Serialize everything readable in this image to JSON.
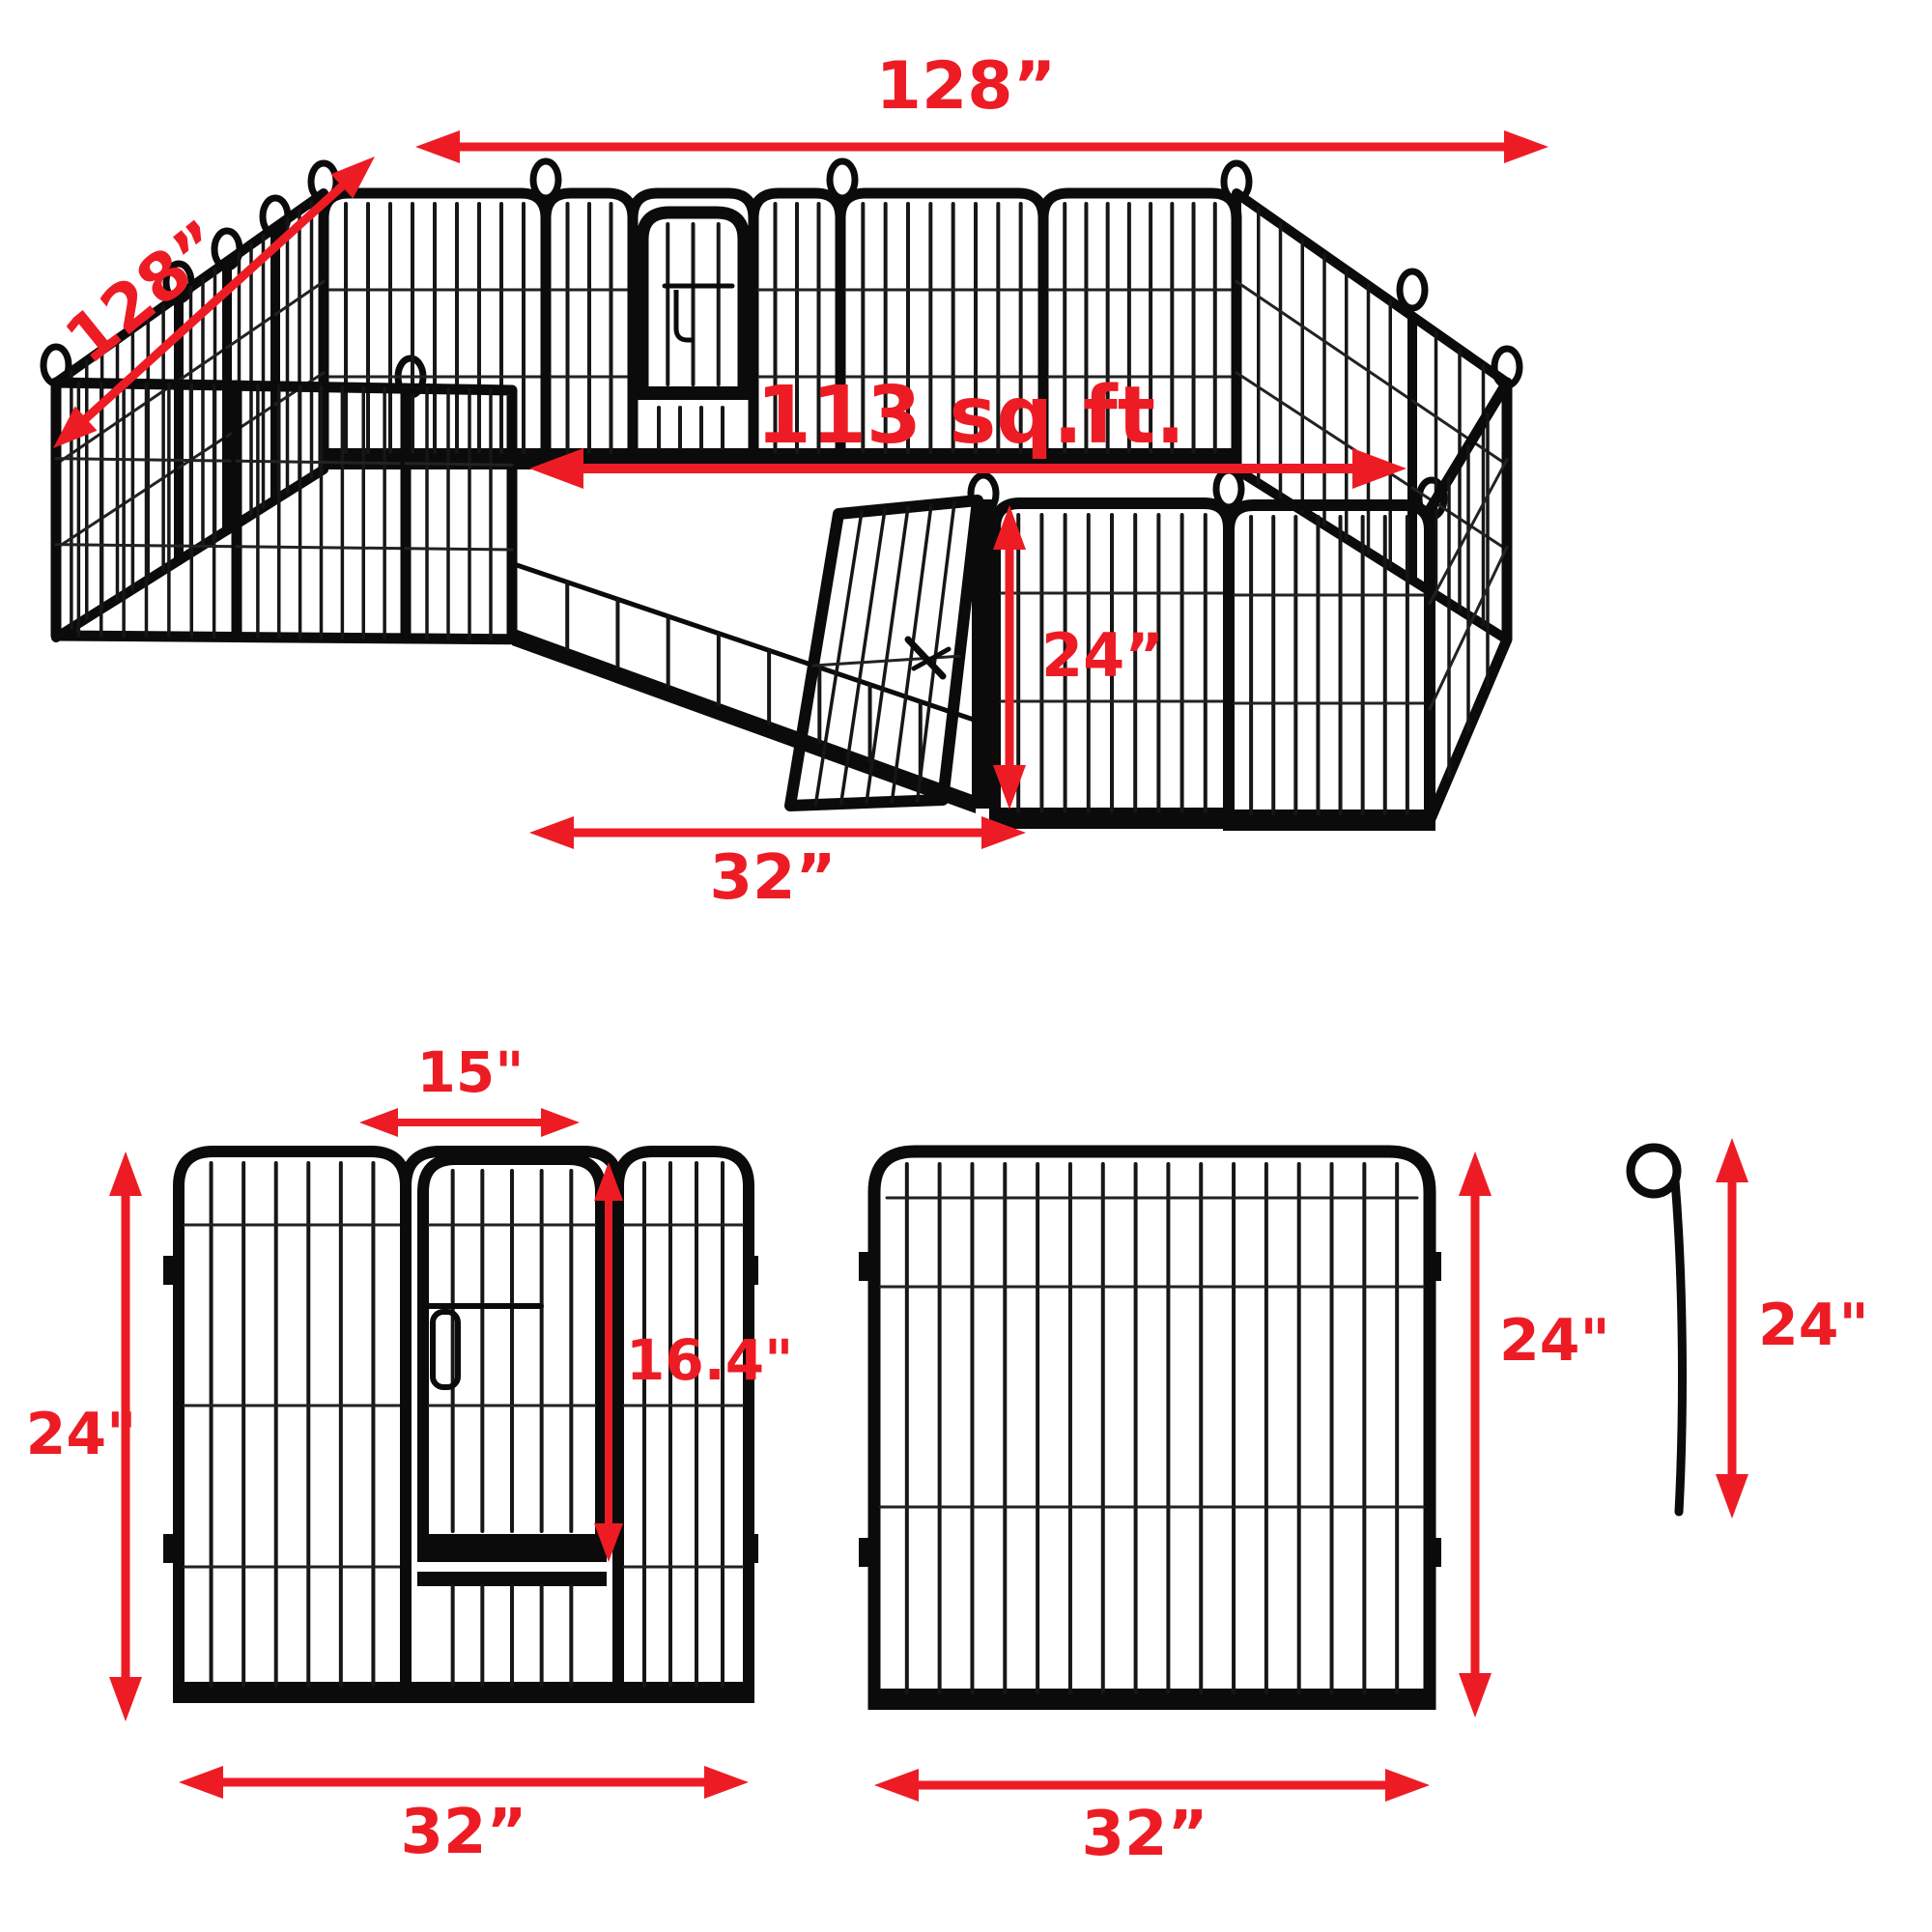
{
  "colors": {
    "dimension_red": "#ed1c24",
    "fence_black": "#0b0b0b",
    "wire_gray": "#222222",
    "background": "#ffffff"
  },
  "assembled_view": {
    "top_width": "128”",
    "side_depth": "128”",
    "area": "113 sq.ft.",
    "front_panel_height": "24”",
    "front_section_width": "32”"
  },
  "door_panel_figure": {
    "door_width": "15\"",
    "panel_height": "24\"",
    "door_height": "16.4\"",
    "panel_width": "32”"
  },
  "plain_panel_figure": {
    "panel_height": "24\"",
    "panel_width": "32”"
  },
  "stake_figure": {
    "stake_height": "24\""
  }
}
